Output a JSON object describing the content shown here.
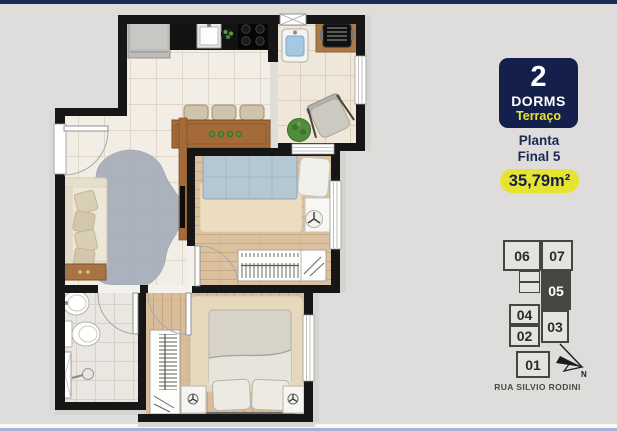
{
  "sidebar": {
    "badge": {
      "number": "2",
      "dorms_label": "DORMS",
      "terrace_label": "Terraço"
    },
    "plan_title": {
      "line1": "Planta",
      "line2": "Final 5"
    },
    "area_badge": "35,79m²",
    "keyplan": {
      "units": {
        "u06": "06",
        "u07": "07",
        "u05": "05",
        "u04": "04",
        "u03": "03",
        "u02": "02",
        "u01": "01"
      },
      "highlighted_unit": "05",
      "north_label": "N",
      "street_label": "RUA SILVIO RODINI"
    }
  },
  "colors": {
    "top_bar": "#1d2a56",
    "bottom_bar": "#a9b2d4",
    "badge_navy": "#14204b",
    "accent_yellow": "#e7e431",
    "keyplan_highlight": "#484641",
    "wall_black": "#161616",
    "background": "#dedddb"
  }
}
